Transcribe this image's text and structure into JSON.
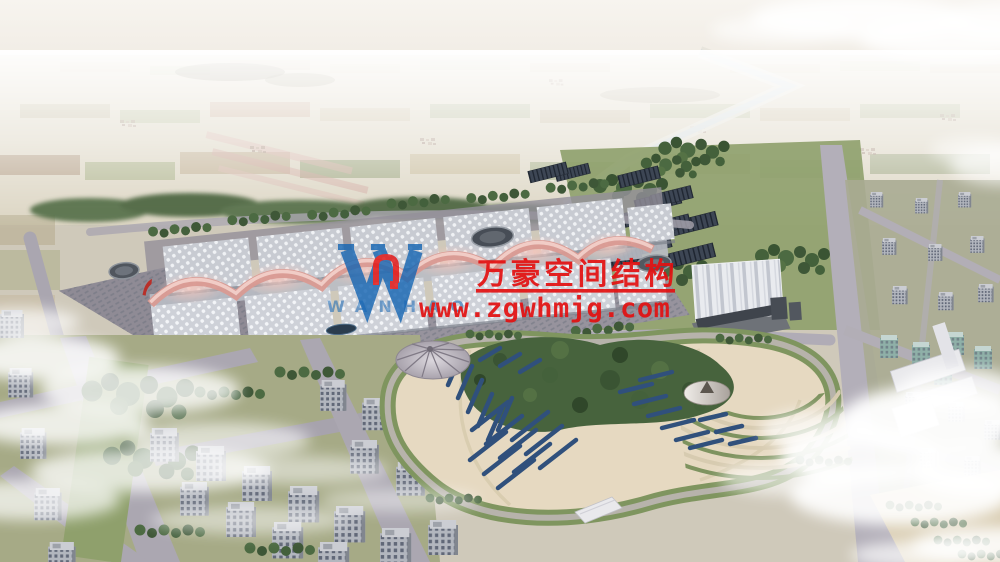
{
  "scene": {
    "type": "architectural-aerial-rendering",
    "subject": "exhibition-center-complex-with-park-and-city",
    "palette": {
      "haze_white": "#f5f2ec",
      "farmland_tan": "#cfc0a0",
      "farmland_green": "#aab284",
      "tree_green": "#4a6741",
      "road_gray": "#aaa6b0",
      "hall_roof": "#c8cbd2",
      "ridge_pink": "#d99a92",
      "solar_navy": "#30507c",
      "dark_array": "#3d4654",
      "park_sand": "#e6d9c1",
      "water_blue": "#2a3c4e"
    }
  },
  "watermark": {
    "logo_monogram": "W",
    "logo_latin_name": "WANHAO",
    "company_name_cn": "万豪空间结构",
    "website_url": "www.zgwhmjg.com",
    "brand_blue": "#1766b3",
    "brand_red": "#e21212"
  }
}
